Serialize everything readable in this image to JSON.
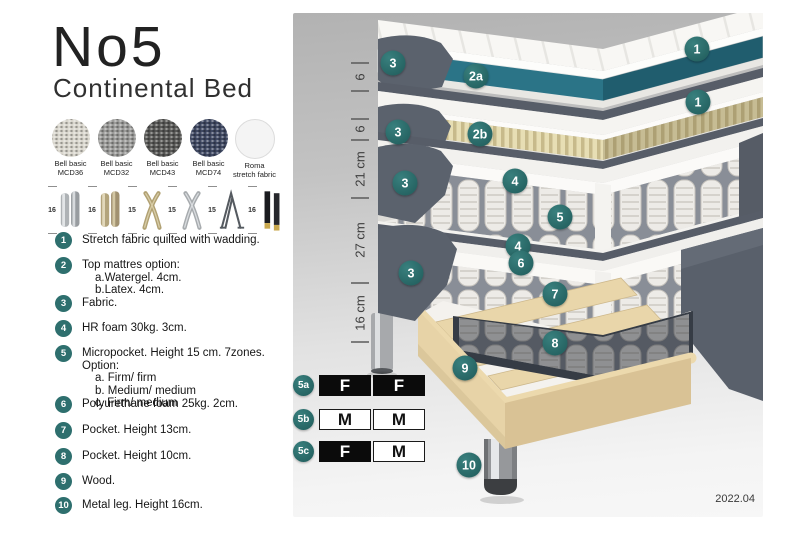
{
  "title": "No5",
  "subtitle": "Continental Bed",
  "fabrics": [
    {
      "name": "Bell basic",
      "code": "MCD36",
      "color": "#d9d6cd"
    },
    {
      "name": "Bell basic",
      "code": "MCD32",
      "color": "#9b9b99"
    },
    {
      "name": "Bell basic",
      "code": "MCD43",
      "color": "#585856"
    },
    {
      "name": "Bell basic",
      "code": "MCD74",
      "color": "#3f4862"
    },
    {
      "name": "Roma",
      "code": "stretch fabric",
      "color": "#f4f4f4"
    }
  ],
  "leg_options": [
    {
      "height": "16",
      "type": "cylinder-silver"
    },
    {
      "height": "16",
      "type": "cylinder-gold"
    },
    {
      "height": "15",
      "type": "cross-gold"
    },
    {
      "height": "15",
      "type": "cross-silver"
    },
    {
      "height": "15",
      "type": "hairpin"
    },
    {
      "height": "16",
      "type": "black-gold"
    }
  ],
  "features": [
    {
      "num": "1",
      "text": "Stretch fabric quilted with wadding.",
      "subs": []
    },
    {
      "num": "2",
      "text": "Top mattres option:",
      "subs": [
        "a.Watergel. 4cm.",
        "b.Latex. 4cm."
      ]
    },
    {
      "num": "3",
      "text": "Fabric.",
      "subs": []
    },
    {
      "num": "4",
      "text": "HR foam 30kg. 3cm.",
      "subs": []
    },
    {
      "num": "5",
      "text": "Micropocket. Height 15 cm. 7zones. Option:",
      "subs": [
        "a. Firm/ firm",
        "b. Medium/ medium",
        "c. Firm/ medium"
      ]
    },
    {
      "num": "6",
      "text": "Polyurethane foam 25kg. 2cm.",
      "subs": []
    },
    {
      "num": "7",
      "text": "Pocket. Height 13cm.",
      "subs": []
    },
    {
      "num": "8",
      "text": "Pocket. Height 10cm.",
      "subs": []
    },
    {
      "num": "9",
      "text": "Wood.",
      "subs": []
    },
    {
      "num": "10",
      "text": "Metal leg. Height 16cm.",
      "subs": []
    }
  ],
  "measurements": [
    "6",
    "6",
    "21 cm",
    "27 cm",
    "16 cm"
  ],
  "callouts": [
    "1",
    "2a",
    "3",
    "1",
    "2b",
    "3",
    "4",
    "5",
    "4",
    "3",
    "6",
    "7",
    "8",
    "3",
    "9",
    "10"
  ],
  "firmness": [
    {
      "label": "5a",
      "cells": [
        {
          "text": "F",
          "style": "dark"
        },
        {
          "text": "F",
          "style": "dark"
        }
      ]
    },
    {
      "label": "5b",
      "cells": [
        {
          "text": "M",
          "style": "light"
        },
        {
          "text": "M",
          "style": "light"
        }
      ]
    },
    {
      "label": "5c",
      "cells": [
        {
          "text": "F",
          "style": "dark"
        },
        {
          "text": "M",
          "style": "light"
        }
      ]
    }
  ],
  "version": "2022.04",
  "colors": {
    "accent_teal": "#2E6F6E",
    "watergel_teal": "#2B7487",
    "latex_tan": "#E7DEB4",
    "fabric_gray": "#5B626D",
    "wood": "#E7D3A7",
    "table_black": "#0B0B0B"
  }
}
